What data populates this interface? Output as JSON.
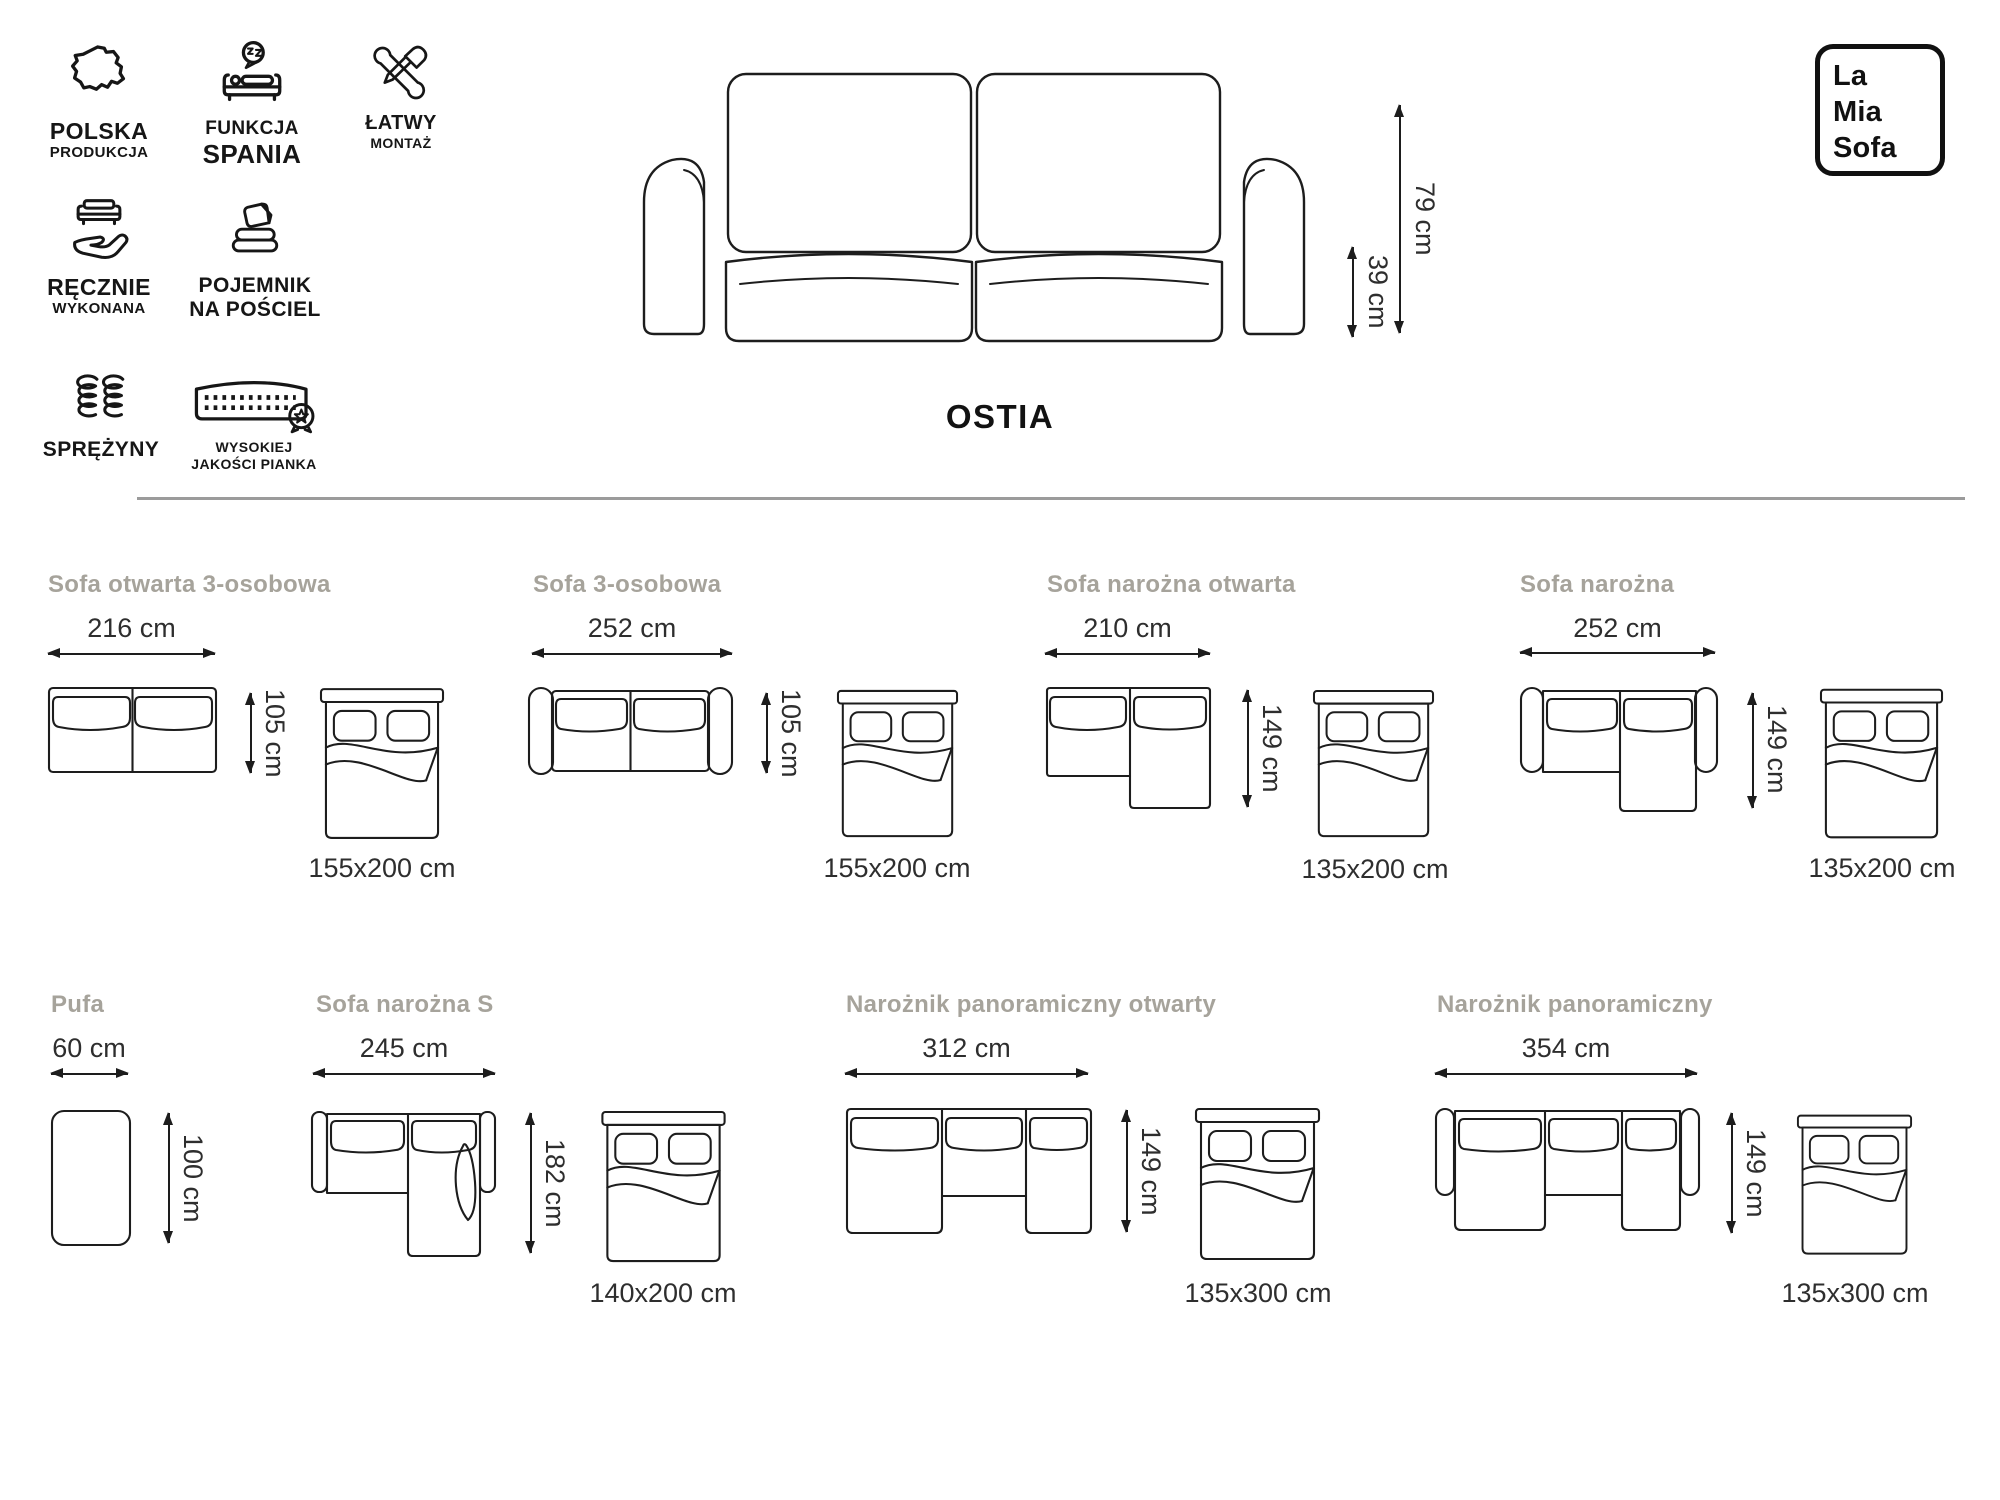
{
  "brand_logo": {
    "line1": "La",
    "line2": "Mia",
    "line3": "Sofa"
  },
  "product": {
    "name": "OSTIA",
    "total_height": "79 cm",
    "seat_height": "39 cm"
  },
  "features": [
    {
      "icon": "poland-map-icon",
      "line1": "POLSKA",
      "line2": "PRODUKCJA"
    },
    {
      "icon": "sleep-function-icon",
      "line1": "FUNKCJA",
      "line2": "SPANIA"
    },
    {
      "icon": "easy-assembly-icon",
      "line1": "ŁATWY",
      "line2": "MONTAŻ"
    },
    {
      "icon": "handmade-icon",
      "line1": "RĘCZNIE",
      "line2": "WYKONANA"
    },
    {
      "icon": "bedding-storage-icon",
      "line1": "POJEMNIK",
      "line2": "NA POŚCIEL"
    },
    {
      "icon": "springs-icon",
      "line1": "SPRĘŻYNY",
      "line2": ""
    },
    {
      "icon": "foam-quality-icon",
      "line1": "WYSOKIEJ",
      "line2": "JAKOŚCI PIANKA"
    }
  ],
  "configurations": [
    {
      "title": "Sofa otwarta 3-osobowa",
      "width": "216 cm",
      "depth": "105 cm",
      "bed_size": "155x200 cm"
    },
    {
      "title": "Sofa 3-osobowa",
      "width": "252 cm",
      "depth": "105 cm",
      "bed_size": "155x200 cm"
    },
    {
      "title": "Sofa narożna otwarta",
      "width": "210 cm",
      "depth": "149 cm",
      "bed_size": "135x200 cm"
    },
    {
      "title": "Sofa narożna",
      "width": "252 cm",
      "depth": "149 cm",
      "bed_size": "135x200 cm"
    },
    {
      "title": "Pufa",
      "width": "60 cm",
      "depth": "100 cm",
      "bed_size": ""
    },
    {
      "title": "Sofa narożna S",
      "width": "245 cm",
      "depth": "182 cm",
      "bed_size": "140x200 cm"
    },
    {
      "title": "Narożnik panoramiczny otwarty",
      "width": "312 cm",
      "depth": "149 cm",
      "bed_size": "135x300 cm"
    },
    {
      "title": "Narożnik panoramiczny",
      "width": "354 cm",
      "depth": "149 cm",
      "bed_size": "135x300 cm"
    }
  ],
  "colors": {
    "line_art": "#1d1d1d",
    "section_title": "#a6a39b",
    "divider": "#9b9b9b",
    "text": "#2e2e2e"
  }
}
